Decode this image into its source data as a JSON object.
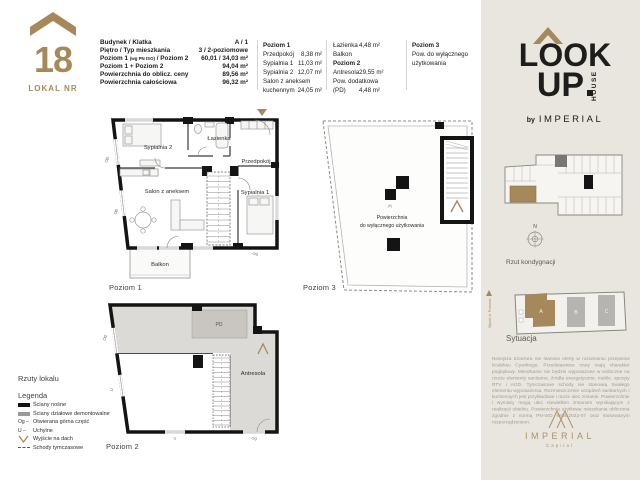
{
  "colors": {
    "gold": "#a6895b",
    "gold_light": "#ab9168",
    "sidebar_bg": "#e9e6e0",
    "wall": "#141414"
  },
  "header": {
    "unit": {
      "number": "18",
      "label": "LOKAL NR"
    },
    "specs": [
      {
        "label": "Budynek / Klatka",
        "value": "A / 1"
      },
      {
        "label": "Piętro / Typ mieszkania",
        "value": "3 / 2-poziomowe"
      },
      {
        "label_pre": "Poziom 1 ",
        "label_small": "(wg PN ISO)",
        "label_post": " / Poziom 2",
        "value": "60,01 / 34,03 m²"
      },
      {
        "label": "Poziom 1 + Poziom 2",
        "value": "94,04 m²"
      },
      {
        "label": "Powierzchnia do oblicz. ceny",
        "value": "89,56 m²"
      },
      {
        "label": "Powierzchnia całościowa",
        "value": "96,32 m²"
      }
    ],
    "rooms": {
      "col1": {
        "header": "Poziom 1",
        "rows": [
          {
            "label": "Przedpokój",
            "value": "8,38 m²"
          },
          {
            "label": "Sypialnia 1",
            "value": "11,03 m²"
          },
          {
            "label": "Sypialnia 2",
            "value": "12,07 m²"
          },
          {
            "label": "Salon z aneksem",
            "value": ""
          },
          {
            "label": "kuchennym",
            "value": "24,05 m²"
          }
        ]
      },
      "col2": {
        "rows": [
          {
            "label": "Łazienka",
            "value": "4,48 m²"
          },
          {
            "label": "Balkon",
            "value": ""
          },
          {
            "label": "Poziom 2",
            "value": ""
          },
          {
            "label": "Antresola",
            "value": "29,55 m²"
          },
          {
            "label": "Pow. dodatkowa",
            "value": ""
          },
          {
            "label": "(PD)",
            "value": "4,48 m²"
          }
        ]
      },
      "col3": {
        "header": "Poziom 3",
        "lines": [
          "Pow. do wyłącznego",
          "użytkowania"
        ]
      }
    }
  },
  "plans": {
    "p1": {
      "caption": "Poziom 1",
      "labels": {
        "sypialnia2": "Sypialnia 2",
        "lazienka": "Łazienka",
        "przedpokoj": "Przedpokój",
        "salon": "Salon z aneksem",
        "sypialnia1": "Sypialnia 1",
        "balkon": "Balkon"
      }
    },
    "p2": {
      "caption": "Poziom 2",
      "labels": {
        "antresola": "Antresola",
        "pd": "PD"
      }
    },
    "p3": {
      "caption": "Poziom 3",
      "labels": {
        "line1": "Powierzchnia",
        "line2": "do wyłącznego użytkowania",
        "marker": "(K)"
      }
    },
    "symbols": {
      "top_hung": "Og",
      "tilt": "U"
    }
  },
  "legend": {
    "plans_title": "Rzuty lokalu",
    "title": "Legenda",
    "items": [
      {
        "label": "Ściany nośne"
      },
      {
        "label": "Ściany działowe demontowalne"
      },
      {
        "symbol": "Og –",
        "label": "Otwierana górna część"
      },
      {
        "symbol": "U –",
        "label": "Uchylne"
      },
      {
        "label": "Wyjście na dach"
      },
      {
        "label": "Schody tymczasowe"
      }
    ]
  },
  "sidebar": {
    "logo": {
      "word1": "LOOK",
      "word2": "UP",
      "vertical": "HOUSE",
      "by": "by",
      "brand": "IMPERIAL"
    },
    "floorplan_caption": "Rzut kondygnacji",
    "compass_n": "N",
    "site": {
      "caption": "Sytuacja",
      "buildings": [
        "A",
        "B",
        "C"
      ],
      "entry": "Wjazd ul. Przewóz"
    },
    "disclaimer": "Niniejsza broszura nie stanowi oferty w rozumieniu przepisów Kodeksu Cywilnego. Przedstawione rzuty mają charakter poglądowy. Mieszkanie nie będzie wyposażone w widoczne na rzucie elementy sanitarne, źródła energetyczne, meble, sprzęty RTV i AGD. Tymczasowe schody nie stanowią trwałego elementu wyposażenia. Rozmieszczenie urządzeń sanitarnych i kuchennych jest przykładowe i może ulec zmianie. Powierzchnie i wymiary mogą ulec niewielkim zmianom wynikającym z realizacji obiektu. Powierzchnia użytkowa mieszkania obliczona zgodnie z normą PN-ISO 9836:2022-07 oraz stosowanym rozporządzeniem.",
    "footer": {
      "brand": "IMPERIAL",
      "sub": "Capital"
    }
  }
}
